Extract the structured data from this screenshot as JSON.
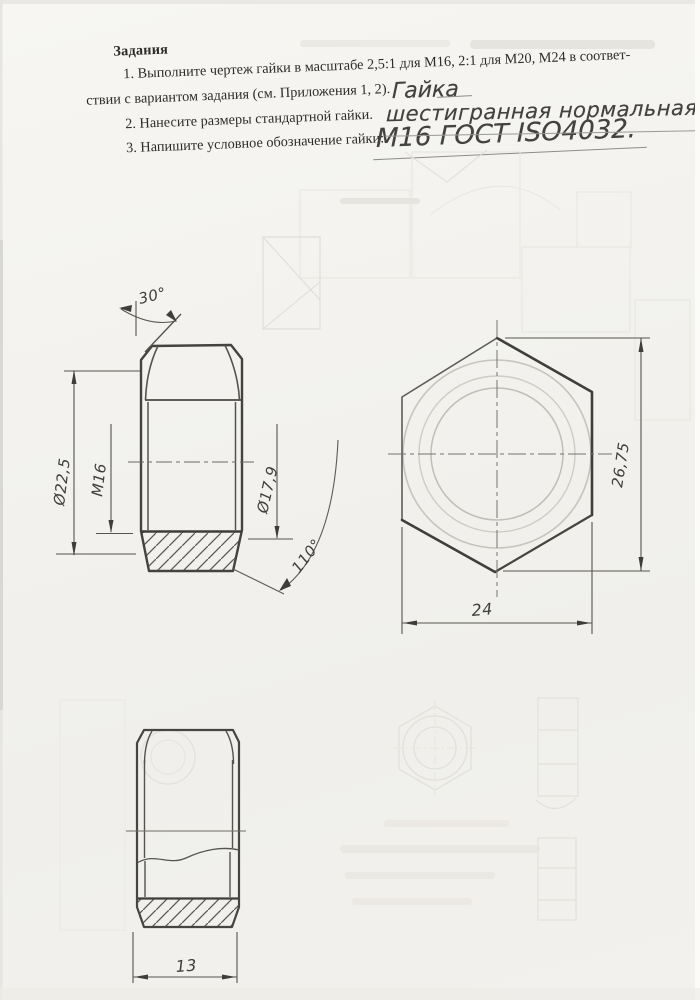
{
  "header": {
    "title": "Задания",
    "task1_line1": "1.  Выполните чертеж гайки в масштабе 2,5:1 для М16, 2:1 для М20, М24 в соответ-",
    "task1_line2": "ствии с вариантом задания (см. Приложения 1, 2).",
    "task2": "2.  Нанесите размеры стандартной гайки.",
    "task3": "3.  Напишите условное обозначение гайки:"
  },
  "handwriting": {
    "line1": "Гайка",
    "line2": "шестигранная нормальная",
    "line3": "М16 ГОСТ ISO4032."
  },
  "drawing": {
    "front_view": {
      "angle_top": "30°",
      "dia_outer": "Ø22,5",
      "thread": "M16",
      "dia_chamfer": "Ø17,9",
      "angle_bottom": "110°"
    },
    "top_view": {
      "across_corners": "26,75",
      "across_flats": "24"
    },
    "detail_view": {
      "width": "13"
    }
  },
  "colors": {
    "paper": "#f3f2ee",
    "printed_ink": "#2e2c29",
    "pencil_dark": "#454340",
    "pencil_light": "#c7c4bd",
    "ghost_marks": "#e4e2dd"
  }
}
